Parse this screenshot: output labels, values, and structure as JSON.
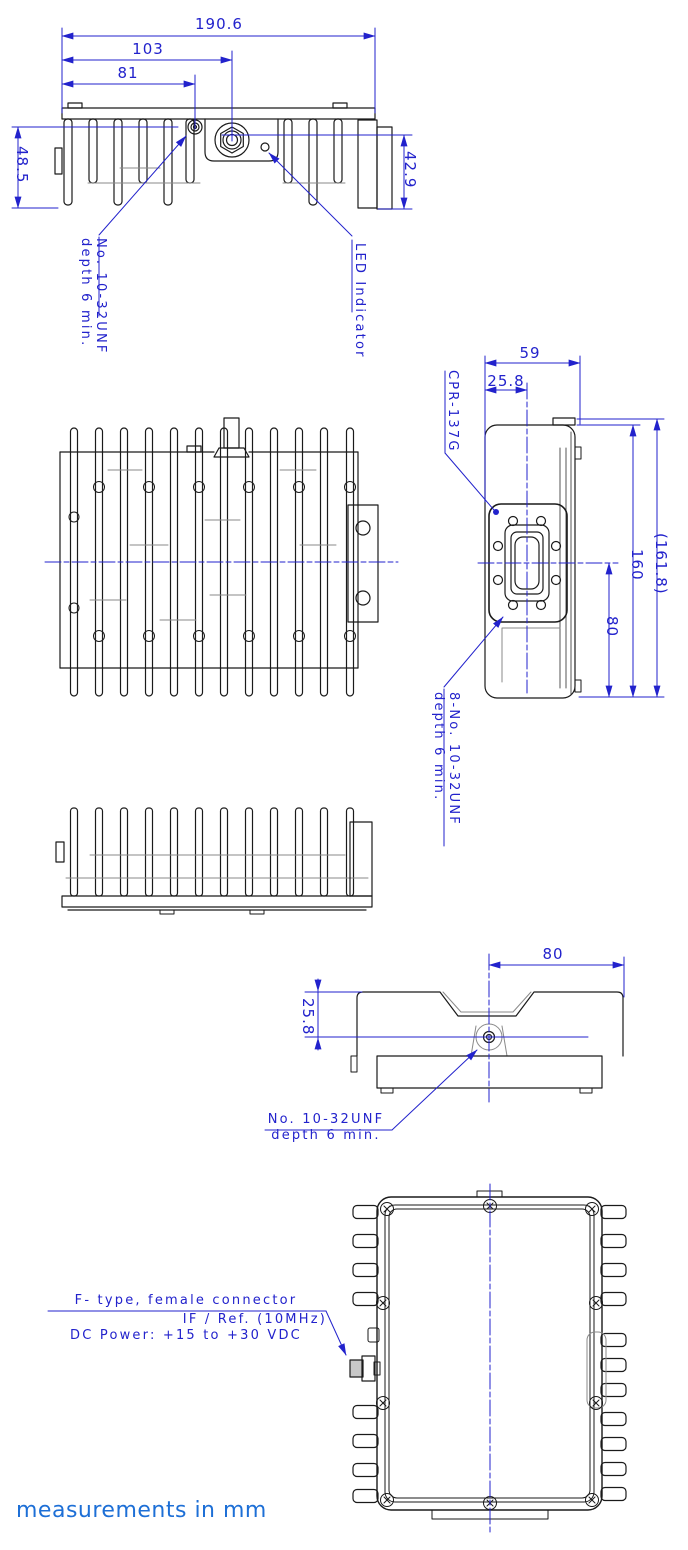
{
  "colors": {
    "dimension_blue": "#2222cc",
    "note_blue": "#1d6fd6",
    "line_black": "#1a1a1a"
  },
  "top_view": {
    "dim_width_total": "190.6",
    "dim_width_to_center": "103",
    "dim_width_to_screw": "81",
    "dim_height_left": "48.5",
    "dim_height_right": "42.9",
    "screw_note_line1": "No. 10-32UNF",
    "screw_note_line2": "depth 6 min.",
    "led_note": "LED Indicator"
  },
  "side_view": {
    "dim_width": "59",
    "dim_flange_offset": "25.8",
    "flange_label": "CPR-137G",
    "dim_height": "160",
    "dim_height_overall": "(161.8)",
    "dim_center_to_bottom": "80",
    "flange_screw_note_line1": "8-No. 10-32UNF",
    "flange_screw_note_line2": "depth 6 min."
  },
  "end_view": {
    "dim_center_to_edge": "80",
    "dim_top_to_screw": "25.8",
    "screw_note_line1": "No. 10-32UNF",
    "screw_note_line2": "depth 6 min."
  },
  "bottom_view": {
    "connector_note_line1": "F- type, female connector",
    "connector_note_line2": "IF / Ref. (10MHz)",
    "connector_note_line3": "DC Power: +15 to +30 VDC"
  },
  "footer": {
    "units_note": "measurements in mm"
  }
}
